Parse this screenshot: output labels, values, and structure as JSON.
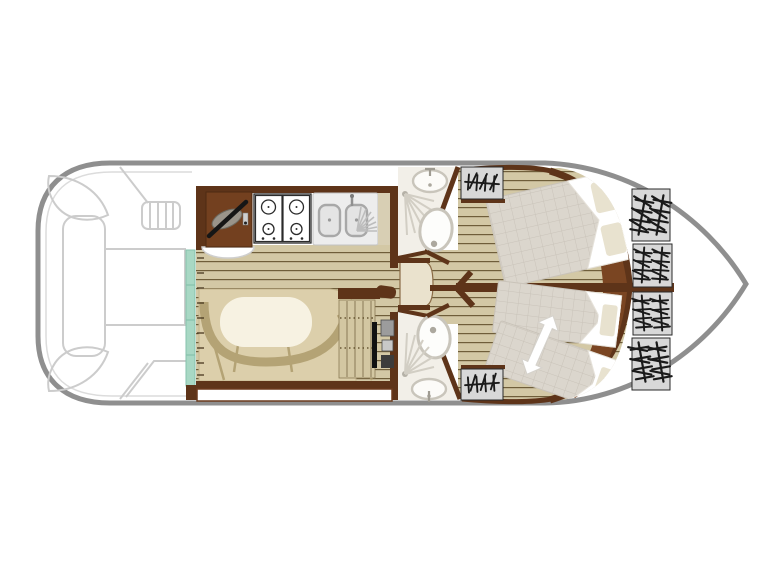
{
  "page": {
    "background": "#ffffff",
    "content": "boat-deck-plan-diagram"
  },
  "boat": {
    "orientation": {
      "bow": "right",
      "stern": "left"
    },
    "regions": [
      {
        "name": "aft-deck",
        "items": [
          "corner-seat",
          "corner-seat",
          "bench-seat",
          "deck-table-hatch",
          "boarding-steps"
        ]
      },
      {
        "name": "galley",
        "items": [
          "helm-station",
          "gear-lever",
          "pilot-seat",
          "gas-hob",
          "double-sink",
          "sink-tap",
          "drainer",
          "worktop"
        ]
      },
      {
        "name": "saloon",
        "items": [
          "u-shaped-sofa",
          "dining-table",
          "companionway-steps",
          "instrument-panel",
          "sliding-door"
        ]
      },
      {
        "name": "shower-room-port",
        "items": [
          "washbasin",
          "shower",
          "toilet"
        ]
      },
      {
        "name": "shower-room-starboard",
        "items": [
          "washbasin",
          "shower",
          "toilet"
        ]
      },
      {
        "name": "wardrobe",
        "items": [
          "wardrobe-cabinet"
        ]
      },
      {
        "name": "cabin-port",
        "items": [
          "double-bed",
          "pillow",
          "pillow",
          "entry-steps-panel"
        ]
      },
      {
        "name": "cabin-starboard",
        "items": [
          "single-bed",
          "single-bed",
          "pillow",
          "pillow",
          "convertible-beds-arrow",
          "entry-steps-panel"
        ]
      },
      {
        "name": "bow-locker",
        "items": [
          "step-panel",
          "step-panel",
          "step-panel",
          "step-panel"
        ]
      }
    ],
    "counts": {
      "hob_burners": 4,
      "bow_step_panels": 4,
      "cabins": 2,
      "shower_rooms": 2,
      "double_beds": 1,
      "single_beds": 2,
      "pillows_total": 4
    }
  },
  "colors": {
    "hull_outline": "#8f8f8f",
    "deck_line": "#cccccc",
    "wall": "#5e3419",
    "wall_light": "#7a4522",
    "wood": "#d3c8a5",
    "wood_line": "#6f5e3a",
    "sofa": "#dccfab",
    "sofa_shadow": "#b4a375",
    "table": "#f7f2e2",
    "door_teal": "#a8d8c4",
    "bath_floor": "#f2efe8",
    "fixture": "#c9c5bb",
    "fixture_dark": "#aca89e",
    "quilt": "#dbd6cd",
    "quilt_line": "#c9c3b9",
    "pillow": "#e8e2cf",
    "panel_gray": "#d8d8d8",
    "glyph": "#1a1a1a",
    "steel": "#ededed",
    "stove_line": "#2b2b2b",
    "counter": "#d8cfb4",
    "steps_wood": "#d3c7a2"
  }
}
